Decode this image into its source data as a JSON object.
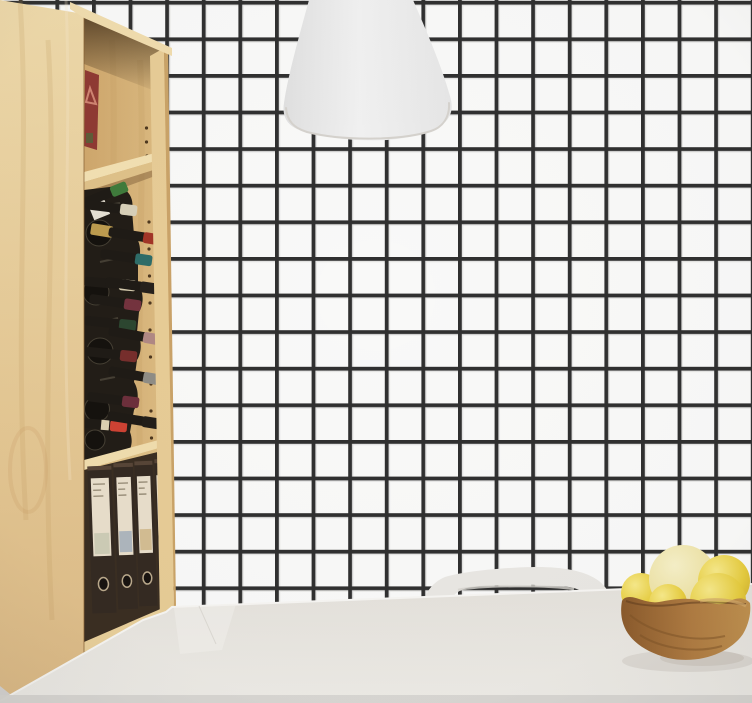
{
  "scene": {
    "title": "Minimal kitchen corner: black grid-tile wall, birch shelving unit with wine bottles and binders, white pendant lamp, white table with chair and wooden fruit bowl",
    "objects": [
      {
        "name": "grid-tile-wall",
        "description": "white wall with square black grout grid"
      },
      {
        "name": "pendant-lamp",
        "description": "white bell-shaped pendant shade at top center"
      },
      {
        "name": "bookshelf",
        "description": "tall birch shelving unit on the left"
      },
      {
        "name": "red-box",
        "description": "dark red box leaning on top shelf"
      },
      {
        "name": "wine-rack",
        "description": "horizontal wine bottles with colored foil capsules"
      },
      {
        "name": "binders",
        "description": "four dark lever-arch binders with cream spine labels"
      },
      {
        "name": "chair",
        "description": "white chair backrest behind the table"
      },
      {
        "name": "dining-table",
        "description": "white tabletop across the bottom"
      },
      {
        "name": "fruit-bowl",
        "description": "carved wooden bowl with yellow fruit"
      }
    ]
  },
  "palette": {
    "wall": "#f9f9f8",
    "grid_line": "#303030",
    "grid_line_soft": "#e3e3e2",
    "lamp_shade": "#ececec",
    "wood_light": "#ecd5a4",
    "wood_mid": "#d9b87e",
    "wood_dark": "#8a6538",
    "table": "#e9e6e1",
    "chair": "#e9e7e3",
    "binder_body": "#342a22",
    "binder_label": "#e8decb",
    "bowl_wood": "#a87843",
    "fruit_yellow": "#e9d04c",
    "fruit_pale": "#efe5ad"
  },
  "shelf": {
    "compartment_count": 3,
    "wine_bottles": {
      "count": 14,
      "capsule_colors": [
        "#3f7b3b",
        "#d8d0b8",
        "#a23527",
        "#2e6d68",
        "#d5cbae",
        "#26211c",
        "#74333e",
        "#2c4630",
        "#b08884",
        "#772e2c",
        "#8f8d86",
        "#6d2f3b",
        "#ce4233",
        "#221e19"
      ]
    },
    "binders": {
      "count": 4,
      "label_block_colors": [
        "#cdccb6",
        "#aeb6bd",
        "#d3bd92",
        "#d2a368"
      ]
    }
  },
  "fruit_bowl": {
    "fruit_count": 5,
    "fruit_colors": [
      "#e3c94a",
      "#eee3a9",
      "#e8cf48",
      "#ecd242",
      "#e8d058"
    ]
  }
}
